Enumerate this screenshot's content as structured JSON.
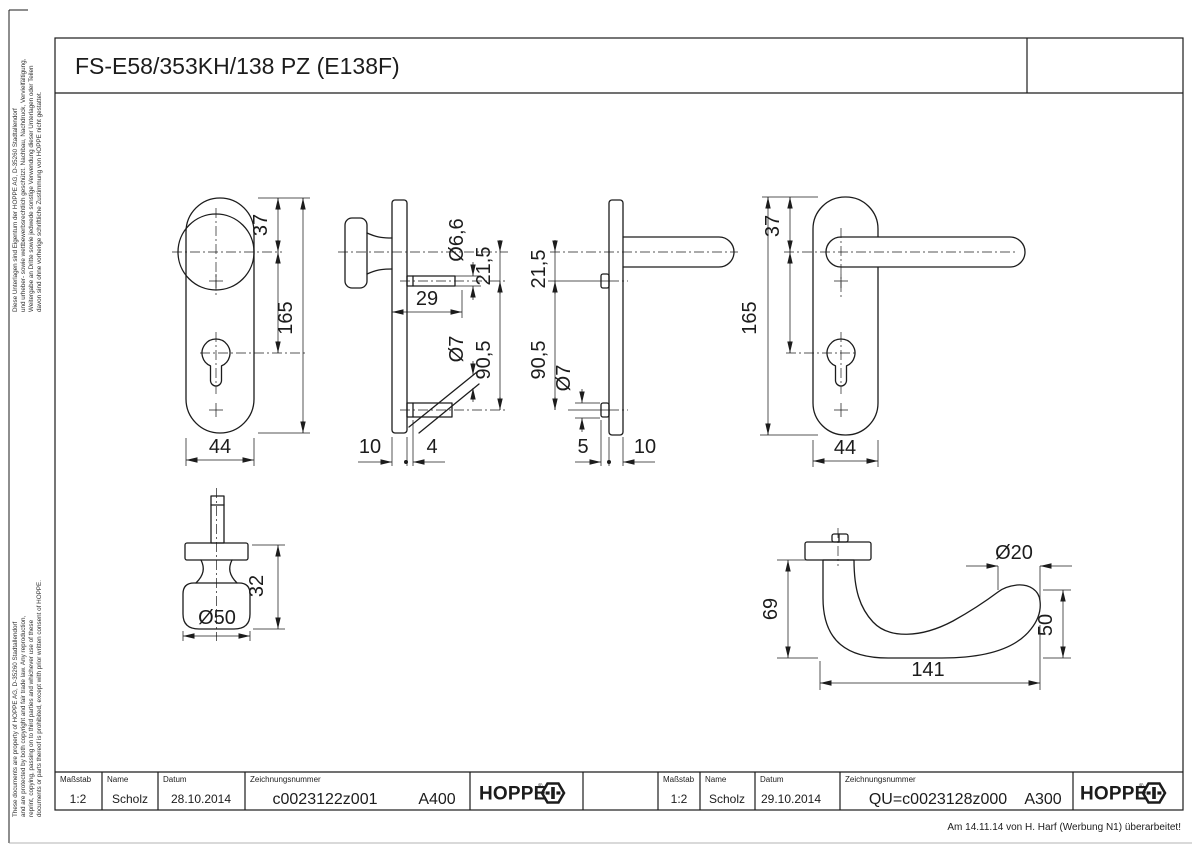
{
  "page": {
    "title": "FS-E58/353KH/138 PZ (E138F)",
    "footer_note": "Am 14.11.14 von H. Harf (Werbung N1) überarbeitet!"
  },
  "copyright_de": {
    "l1": "Diese Unterlagen sind Eigentum der HOPPE AG, D-35260 Stadtallendorf",
    "l2": "und urheber- sowie wettbewerbsrechtlich geschützt. Nachbau, Nachdruck, Vervielfältigung,",
    "l3": "Weitergabe an Dritte sowie jedwede sonstige Verwendung dieser Unterlagen oder Teilen",
    "l4": "davon sind ohne vorherige schriftliche Zustimmung von HOPPE nicht gestattet."
  },
  "copyright_en": {
    "l1": "These documents are property of HOPPE AG, D-35260 Stadtallendorf",
    "l2": "and are protected by both copyright and fair trade law. Any reproduction,",
    "l3": "reprint, copying, passing on to third parties and whichever use of these",
    "l4": "documents or parts thereof is prohibited, except with prior written consent of HOPPE."
  },
  "logo": {
    "text": "HOPPE",
    "registered": "®"
  },
  "title_block_left": {
    "scale_label": "Maßstab",
    "scale_value": "1:2",
    "name_label": "Name",
    "name_value": "Scholz",
    "date_label": "Datum",
    "date_value": "28.10.2014",
    "drawing_label": "Zeichnungsnummer",
    "drawing_value": "c0023122z001",
    "code": "A400"
  },
  "title_block_right": {
    "scale_label": "Maßstab",
    "scale_value": "1:2",
    "name_label": "Name",
    "name_value": "Scholz",
    "date_label": "Datum",
    "date_value": "29.10.2014",
    "drawing_label": "Zeichnungsnummer",
    "drawing_value": "QU=c0023128z000",
    "code": "A300"
  },
  "dims": {
    "v1_37": "37",
    "v1_165": "165",
    "v1_44": "44",
    "v2_d66": "Ø6,6",
    "v2_215": "21,5",
    "v2_29": "29",
    "v2_d7": "Ø7",
    "v2_905": "90,5",
    "v2_10": "10",
    "v2_4": "4",
    "v3_215": "21,5",
    "v3_905": "90,5",
    "v3_d7": "Ø7",
    "v3_5": "5",
    "v3_10": "10",
    "v4_37": "37",
    "v4_165": "165",
    "v4_44": "44",
    "knob_32": "32",
    "knob_d50": "Ø50",
    "lever_69": "69",
    "lever_d20": "Ø20",
    "lever_50": "50",
    "lever_141": "141"
  }
}
